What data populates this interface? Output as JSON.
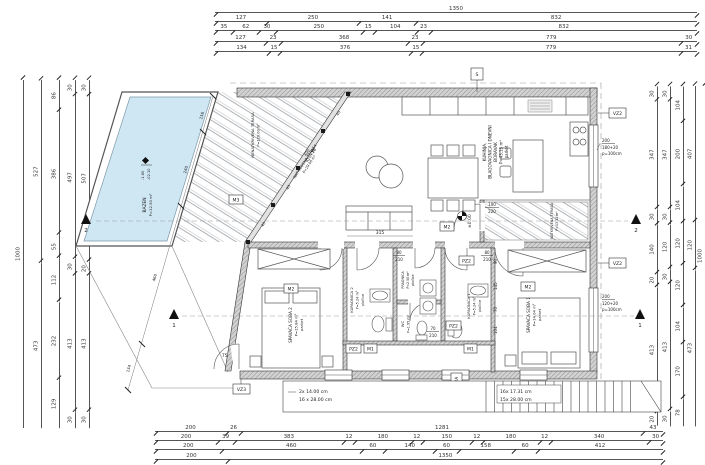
{
  "dims": {
    "top": {
      "r1": [
        "1350"
      ],
      "r2": [
        "127",
        "250",
        "141",
        "832"
      ],
      "r3": [
        "35",
        "62",
        "30",
        "250",
        "15",
        "104",
        "23",
        "832"
      ],
      "r4": [
        "127",
        "23",
        "368",
        "23",
        "779",
        "30"
      ],
      "r5": [
        "134",
        "15",
        "376",
        "15",
        "779",
        "31"
      ]
    },
    "bottom": {
      "r1": [
        "200",
        "26",
        "1281",
        "43"
      ],
      "r2": [
        "200",
        "39",
        "383",
        "12",
        "180",
        "12",
        "150",
        "12",
        "180",
        "12",
        "340",
        "30"
      ],
      "r3": [
        "200",
        "460",
        "60",
        "140",
        "60",
        "158",
        "60",
        "412"
      ],
      "r4": [
        "200",
        "1350"
      ]
    },
    "left": {
      "c1": [
        "1000"
      ],
      "c2": [
        "527",
        "473"
      ],
      "c3": [
        "86",
        "386",
        "55",
        "112",
        "232",
        "129"
      ],
      "c4": [
        "30",
        "497",
        "30",
        "413",
        "30"
      ],
      "c5": [
        "30",
        "507",
        "20",
        "413",
        "30"
      ]
    },
    "right": {
      "c1": [
        "30",
        "347",
        "30",
        "140",
        "20",
        "413",
        "20"
      ],
      "c2": [
        "30",
        "347",
        "30",
        "120",
        "30",
        "413",
        "30"
      ],
      "c3": [
        "104",
        "200",
        "104",
        "120",
        "120",
        "104",
        "170",
        "78"
      ],
      "c4": [
        "407",
        "120",
        "473"
      ],
      "c5": [
        "1000"
      ]
    }
  },
  "rooms": {
    "living": {
      "l1": "KUHINJA,",
      "l2": "BLAGOVAONICA I DNEVNI",
      "l3": "BORAVAK",
      "area": "P=43.15 m²",
      "floor": "parket"
    },
    "bedroom2": {
      "name": "SPAVAĆA SOBA 2",
      "area": "P=15.84 m²",
      "floor": "parket"
    },
    "bathroom2": {
      "name": "KUPAONICA 2",
      "area": "P=5.24 m²",
      "floor": "pločice"
    },
    "laundry": {
      "name": "PRAONICA",
      "area": "P=2.50 m²",
      "floor": "pločice"
    },
    "wc": {
      "name": "WC",
      "area": "P=1.95 m²"
    },
    "bathroom1": {
      "name": "KUPAONICA 1",
      "area": "P=5.24 m²",
      "floor": "pločice"
    },
    "bedroom1": {
      "name": "SPAVAĆA SOBA 1",
      "area": "P=14.04 m²",
      "floor": "parket"
    }
  },
  "terraces": {
    "uncovered": {
      "name": "NENATKRIVENA TERASA",
      "area": "P=120.00 m²"
    },
    "covered": {
      "name": "NATKRIVENA TERASA",
      "area": "P=29.00 m²"
    },
    "covered_small": {
      "name": "NATKRIVENA TERASA",
      "area": "P=13.12 m²"
    }
  },
  "pool": {
    "name": "BAZEN",
    "area": "P=12.50 m²",
    "level_top": "-1.60",
    "level_bottom": "-02.10"
  },
  "levels": {
    "ground": "±0.00"
  },
  "markers": {
    "s": "S",
    "vz2": "VZ2",
    "vz3": "VZ3",
    "m1": "M1",
    "m2": "M2",
    "m3": "M3",
    "pz2": "PZ2",
    "a2": "2A",
    "section1": "1",
    "section2": "2"
  },
  "windows": {
    "kitchen": {
      "w": "200",
      "h": "180+20",
      "p": "p=100cm"
    },
    "bedroom1": {
      "w": "200",
      "h": "120+20",
      "p": "p=100cm"
    },
    "bottom": {
      "w": "60",
      "h": "80+20",
      "p": "p=140cm"
    },
    "terrace_door": {
      "w": "100",
      "h": "220"
    },
    "pergola": {
      "w": "400",
      "h": "420+10"
    }
  },
  "doors": {
    "d80": {
      "w": "80",
      "h": "210"
    },
    "d70": {
      "w": "70",
      "h": "210"
    }
  },
  "stairs": {
    "left1": "2x 14.00 cm",
    "left2": "16 x 28.00 cm",
    "right1": "16x 17.31 cm",
    "right2": "15x 28.00 cm"
  },
  "inner_dims": {
    "sofa": "315",
    "hall": [
      "90",
      "145",
      "70",
      "104"
    ],
    "slant": [
      "116",
      "240",
      "460",
      "134"
    ],
    "angle": "75°",
    "cols": [
      "40",
      "36",
      "40",
      "40",
      "40"
    ]
  },
  "colors": {
    "pool_water": "#cfe6f3",
    "wall_fill": "#d2d2d2",
    "line": "#444"
  }
}
